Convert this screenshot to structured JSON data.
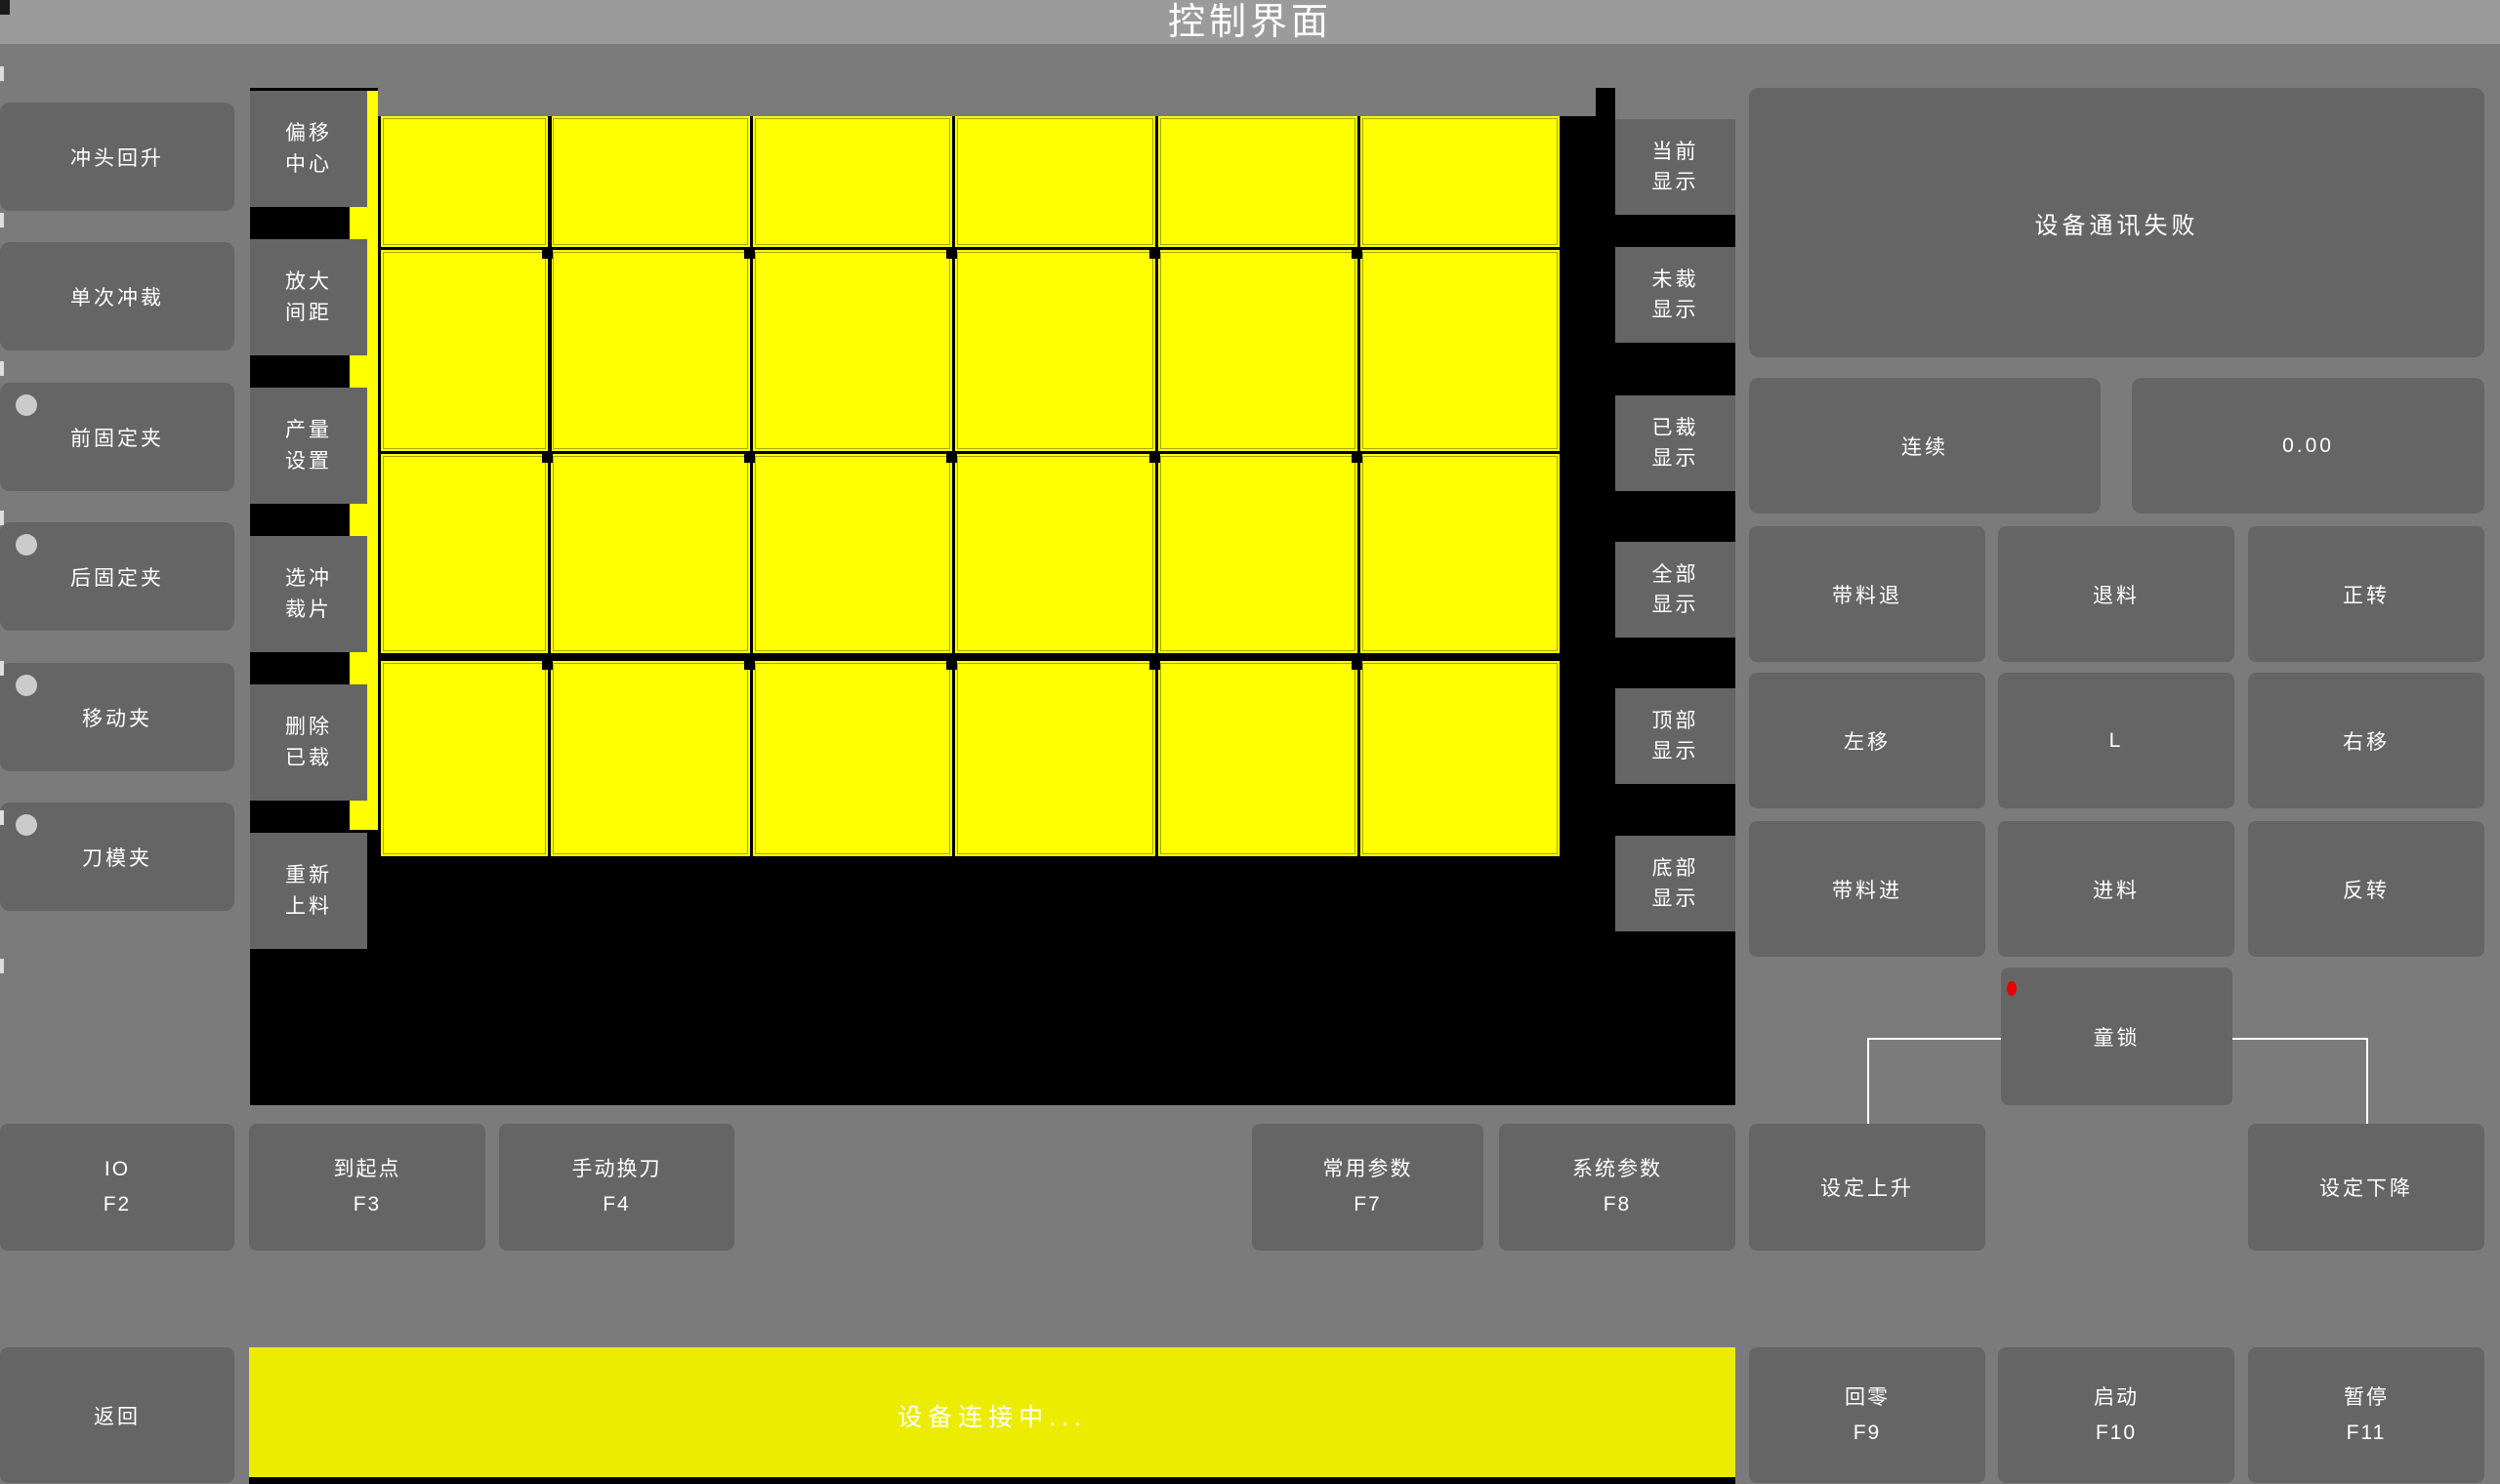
{
  "title_bar": {
    "title": "控制界面"
  },
  "left_column": {
    "buttons": [
      {
        "label": "冲头回升",
        "indicator": false
      },
      {
        "label": "单次冲裁",
        "indicator": false
      },
      {
        "label": "前固定夹",
        "indicator": true
      },
      {
        "label": "后固定夹",
        "indicator": true
      },
      {
        "label": "移动夹",
        "indicator": true
      },
      {
        "label": "刀模夹",
        "indicator": true
      }
    ]
  },
  "tool_column": {
    "buttons": [
      {
        "label": "偏移中心"
      },
      {
        "label": "放大间距"
      },
      {
        "label": "产量设置"
      },
      {
        "label": "选冲裁片"
      },
      {
        "label": "删除已裁"
      },
      {
        "label": "重新上料"
      }
    ]
  },
  "display_column": {
    "buttons": [
      {
        "label": "当前显示"
      },
      {
        "label": "未裁显示"
      },
      {
        "label": "已裁显示"
      },
      {
        "label": "全部显示"
      },
      {
        "label": "顶部显示"
      },
      {
        "label": "底部显示"
      }
    ]
  },
  "canvas": {
    "pieces_columns": 6,
    "pieces_rows": 4,
    "sheet_color": "#ffff00",
    "background": "#000000"
  },
  "right_panel": {
    "message": "设备通讯失败",
    "continuous_label": "连续",
    "value": "0.00",
    "jog_buttons": [
      [
        "带料退",
        "退料",
        "正转"
      ],
      [
        "左移",
        "L",
        "右移"
      ],
      [
        "带料进",
        "进料",
        "反转"
      ]
    ],
    "child_lock_label": "童锁"
  },
  "function_row": {
    "io": {
      "label": "IO",
      "key": "F2"
    },
    "to_origin": {
      "label": "到起点",
      "key": "F3"
    },
    "tool_change": {
      "label": "手动换刀",
      "key": "F4"
    },
    "common_params": {
      "label": "常用参数",
      "key": "F7"
    },
    "system_params": {
      "label": "系统参数",
      "key": "F8"
    },
    "set_rise_label": "设定上升",
    "set_fall_label": "设定下降"
  },
  "bottom_bar": {
    "back_label": "返回",
    "status_text": "设备连接中...",
    "home": {
      "label": "回零",
      "key": "F9"
    },
    "start": {
      "label": "启动",
      "key": "F10"
    },
    "pause": {
      "label": "暂停",
      "key": "F11"
    }
  },
  "colors": {
    "sheet_yellow": "#ffff00",
    "status_bar_yellow": "#ecec00",
    "alert_red": "#e80000",
    "button_gray": "#656565",
    "titlebar_gray": "#9b9b9b"
  }
}
